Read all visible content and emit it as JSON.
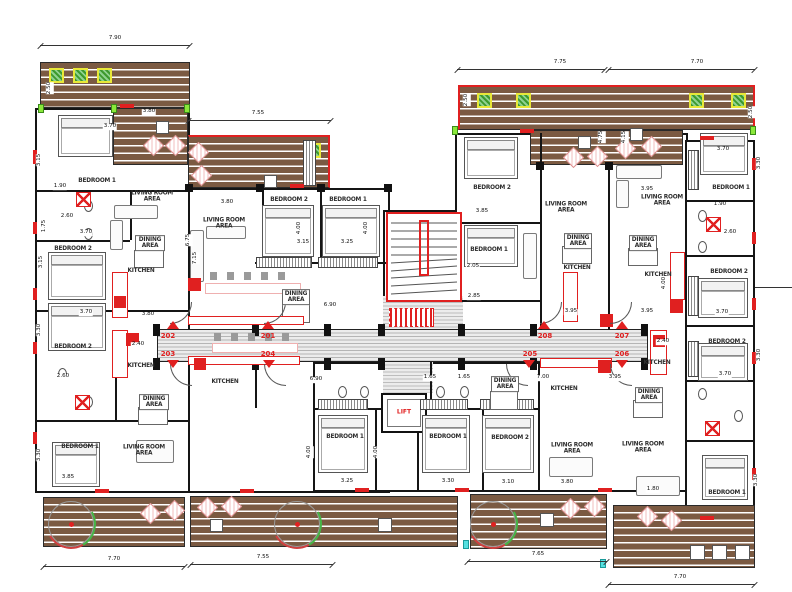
{
  "colors": {
    "deck_brown": "#7b5a42",
    "wall_black": "#151515",
    "accent_red": "#e02020",
    "counter_pink": "#efb0b0",
    "planter_yellow": "#e8e838",
    "plant_green": "#3d9a2e",
    "marker_lime": "#8ae83a",
    "marker_cyan": "#55e0e0",
    "corridor_line": "#aaaaaa",
    "furniture_gray": "#666666"
  },
  "room_labels": [
    "BEDROOM 1",
    "BEDROOM 2",
    "BEDROOM 2",
    "BEDROOM 1",
    "LIVING ROOM AREA",
    "DINING AREA",
    "KITCHEN",
    "KITCHEN",
    "DINING AREA",
    "LIVING ROOM AREA",
    "LIVING ROOM AREA",
    "DINING AREA",
    "KITCHEN",
    "BEDROOM 2",
    "BEDROOM 1",
    "BEDROOM 1",
    "BEDROOM 1",
    "BEDROOM 2",
    "DINING AREA",
    "KITCHEN",
    "LIVING ROOM AREA",
    "BEDROOM 2",
    "BEDROOM 1",
    "LIVING ROOM AREA",
    "DINING AREA",
    "KITCHEN",
    "LIVING ROOM AREA",
    "DINING AREA",
    "KITCHEN",
    "KITCHEN",
    "DINING AREA",
    "LIVING ROOM AREA",
    "BEDROOM 1",
    "BEDROOM 2",
    "BEDROOM 2",
    "BEDROOM 1"
  ],
  "unit_numbers": [
    "202",
    "201",
    "203",
    "204",
    "208",
    "207",
    "205",
    "206"
  ],
  "lift_label": "LIFT",
  "dims_top": [
    "7.90",
    "7.55",
    "7.75",
    "7.70"
  ],
  "dims_bottom": [
    "7.70",
    "7.55",
    "7.65",
    "7.70"
  ],
  "dims_minor": [
    "3.70",
    "2.50",
    "3.15",
    "1.90",
    "2.60",
    "1.75",
    "3.70",
    "3.70",
    "3.30",
    "2.60",
    "3.85",
    "3.30",
    "3.80",
    "3.80",
    "6.75",
    "7.15",
    "3.15",
    "3.25",
    "4.00",
    "4.00",
    "3.80",
    "2.40",
    "6.90",
    "6.90",
    "1.65",
    "1.65",
    "2.05",
    "2.85",
    "3.85",
    "7.00",
    "3.95",
    "3.95",
    "2.40",
    "3.95",
    "3.95",
    "4.00",
    "3.70",
    "3.70",
    "3.70",
    "1.90",
    "2.60",
    "3.25",
    "3.30",
    "3.10",
    "3.80",
    "4.00",
    "4.00",
    "2.50",
    "2.50",
    "4.75",
    "4.15",
    "1.80",
    "3.30",
    "3.30",
    "3.15",
    "3.30"
  ]
}
